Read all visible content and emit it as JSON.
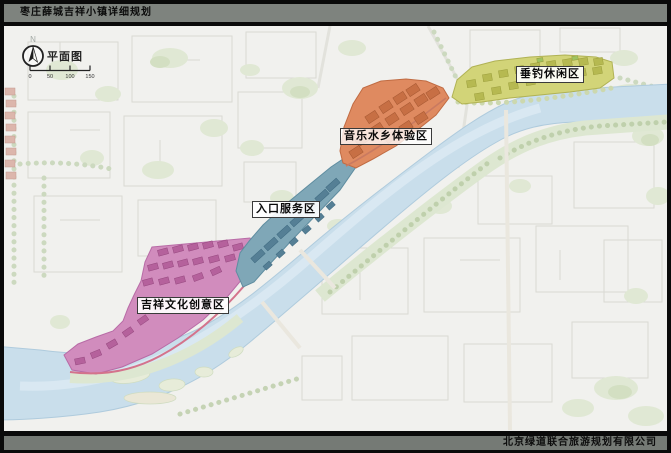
{
  "title_bar": {
    "title": "枣庄薛城吉祥小镇详细规划"
  },
  "footer_bar": {
    "company": "北京绿道联合旅游规划有限公司"
  },
  "map": {
    "plan_label": "平面图",
    "north_label": "N",
    "scale_ticks": [
      "0",
      "50",
      "100",
      "150"
    ],
    "river_color": "#c9deeb",
    "zones": [
      {
        "id": "culture",
        "label": "吉祥文化创意区",
        "color": "#d18cbd"
      },
      {
        "id": "entrance",
        "label": "入口服务区",
        "color": "#7fa7b7"
      },
      {
        "id": "music",
        "label": "音乐水乡体验区",
        "color": "#df8a60"
      },
      {
        "id": "fishing",
        "label": "垂钓休闲区",
        "color": "#d2d478"
      }
    ]
  }
}
